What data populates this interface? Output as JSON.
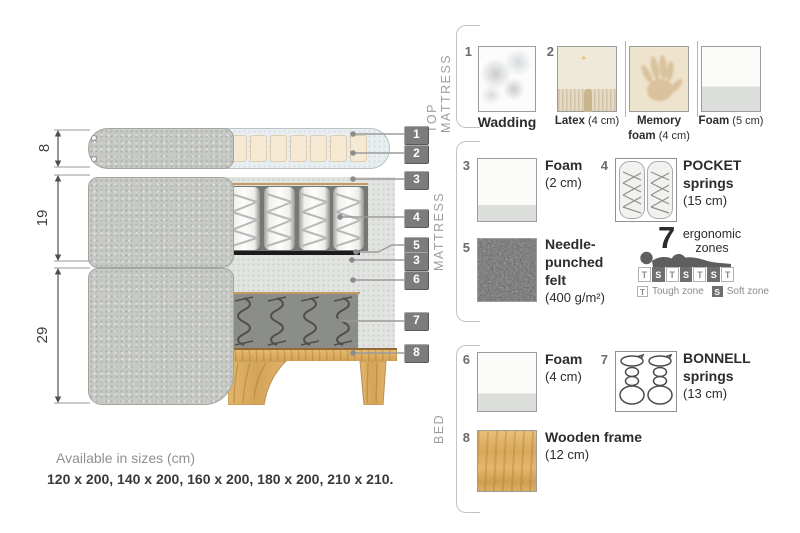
{
  "panel": {
    "top_mattress": {
      "label": "TOP MATTRESS",
      "wadding": {
        "num": "1",
        "name": "Wadding"
      },
      "group2_num": "2",
      "latex": {
        "name": "Latex",
        "size": "(4 cm)"
      },
      "memory": {
        "name": "Memory foam",
        "size": "(4 cm)"
      },
      "foam": {
        "name": "Foam",
        "size": "(5 cm)"
      }
    },
    "mattress": {
      "label": "MATTRESS",
      "foam": {
        "num": "3",
        "name": "Foam",
        "size": "(2 cm)"
      },
      "pocket": {
        "num": "4",
        "name": "POCKET springs",
        "size": "(15 cm)"
      },
      "felt": {
        "num": "5",
        "name": "Needle-punched felt",
        "size": "(400 g/m²)"
      },
      "ergonomic": {
        "count": "7",
        "label": "ergonomic zones",
        "zones": [
          "T",
          "S",
          "T",
          "S",
          "T",
          "S",
          "T"
        ],
        "tough_key": "T",
        "tough_label": "Tough zone",
        "soft_key": "S",
        "soft_label": "Soft zone"
      }
    },
    "bed": {
      "label": "BED",
      "foam": {
        "num": "6",
        "name": "Foam",
        "size": "(4 cm)"
      },
      "bonnell": {
        "num": "7",
        "name": "BONNELL springs",
        "size": "(13 cm)"
      },
      "frame": {
        "num": "8",
        "name": "Wooden frame",
        "size": "(12 cm)"
      }
    }
  },
  "diagram": {
    "dims": {
      "top": "8",
      "middle": "19",
      "bottom": "29"
    },
    "callouts": [
      "1",
      "2",
      "3",
      "4",
      "5",
      "3",
      "6",
      "7",
      "8"
    ]
  },
  "footer": {
    "title": "Available in sizes (cm)",
    "sizes": "120 x 200, 140 x 200, 160 x 200, 180 x 200, 210 x 210."
  },
  "colors": {
    "fabric": "#c7c9c4",
    "wood": "#ddb166",
    "tag": "#7c7c7c",
    "soft_zone": "#6f6f6f",
    "felt": "#777777"
  }
}
